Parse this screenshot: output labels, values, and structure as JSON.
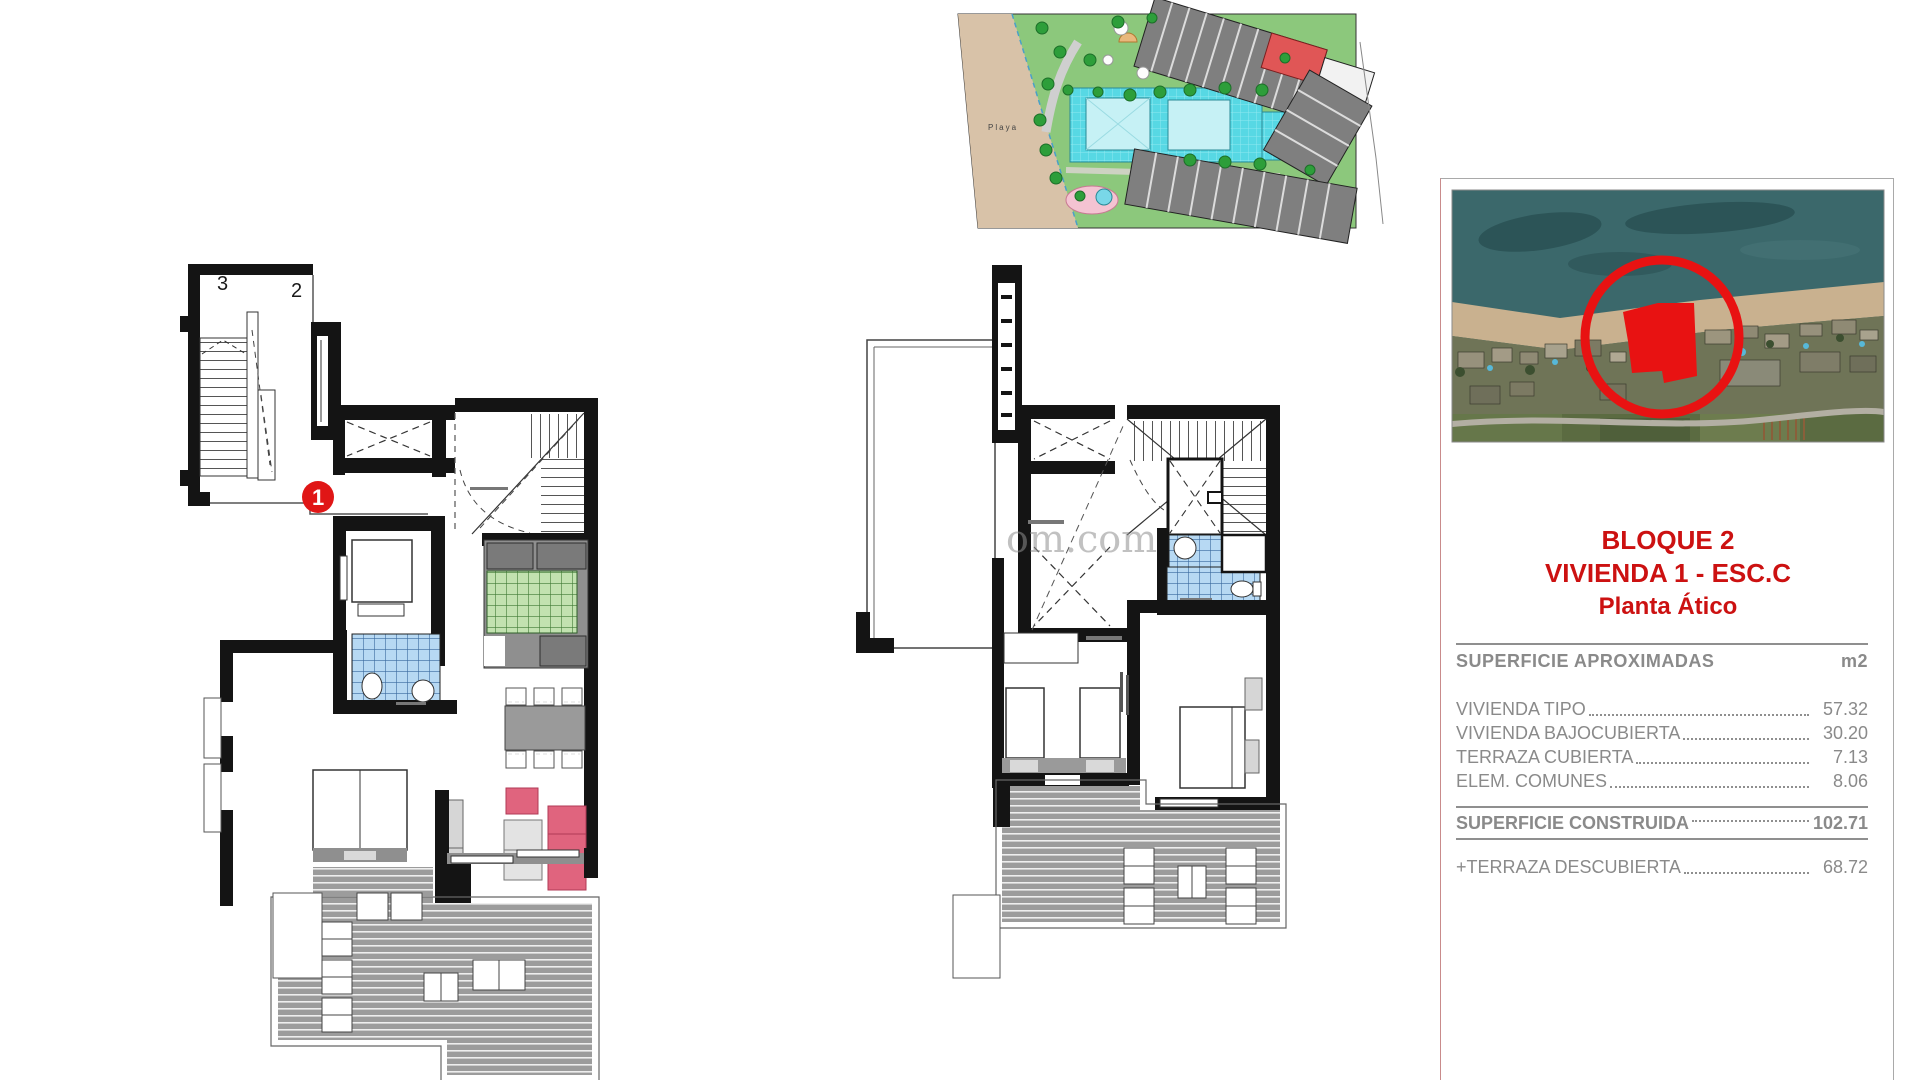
{
  "watermark": {
    "text": "om.com"
  },
  "site_plan": {
    "playa_label": "Playa"
  },
  "left_plan": {
    "stair_label_3": "3",
    "stair_label_2": "2",
    "unit_number": "1"
  },
  "panel": {
    "title_line1": "BLOQUE 2",
    "title_line2": "VIVIENDA 1 - ESC.C",
    "title_line3": "Planta Ático",
    "surface_table": {
      "header_label": "SUPERFICIE APROXIMADAS",
      "header_unit": "m2",
      "rows": [
        {
          "label": "VIVIENDA TIPO",
          "value": "57.32"
        },
        {
          "label": "VIVIENDA BAJOCUBIERTA",
          "value": "30.20"
        },
        {
          "label": "TERRAZA CUBIERTA",
          "value": "7.13"
        },
        {
          "label": "ELEM. COMUNES",
          "value": "8.06"
        }
      ],
      "total_row": {
        "label": "SUPERFICIE CONSTRUIDA",
        "value": "102.71"
      },
      "extra_row": {
        "label": "+TERRAZA DESCUBIERTA",
        "value": "68.72"
      }
    }
  },
  "colors": {
    "accent_red": "#cc1111",
    "badge_red": "#e01616",
    "table_text": "#8a8a8a",
    "tile_blue": "#b7d9f3",
    "tile_green": "#c2e2b0",
    "deck_gray": "#9c9c9c",
    "sofa_pink": "#e0647e",
    "pool_cyan": "#57d8e4",
    "beach_tan": "#d8c2a8",
    "lawn_green": "#8cc87c",
    "sea_teal": "#3b686b"
  }
}
